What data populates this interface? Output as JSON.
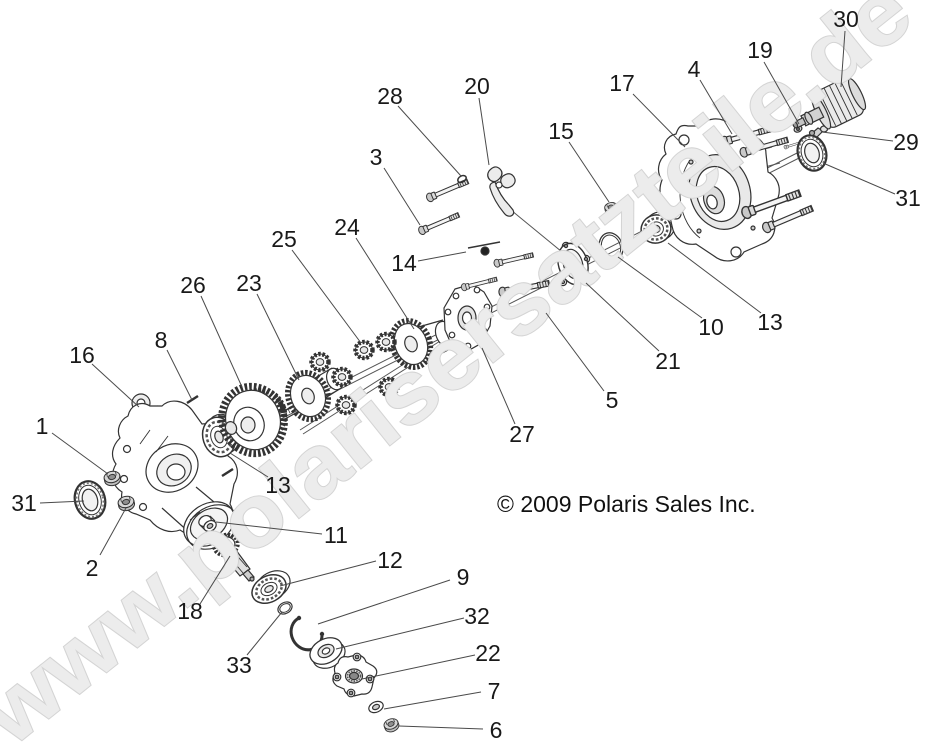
{
  "diagram": {
    "title": "exploded-parts-diagram",
    "copyright": "© 2009 Polaris Sales Inc.",
    "watermark": "www.polarisersatzteile.de"
  },
  "colors": {
    "background": "#ffffff",
    "line_art": "#333333",
    "leader_line": "#4a4a4a",
    "label_text": "#191919",
    "watermark_fill": "#ececec",
    "watermark_outline": "#d4d4d4"
  },
  "labels": [
    {
      "key": "part-label-1",
      "text": "1",
      "x": 42,
      "y": 426,
      "line": [
        52,
        433,
        108,
        474
      ]
    },
    {
      "key": "part-label-2",
      "text": "2",
      "x": 92,
      "y": 568,
      "line": [
        100,
        555,
        126,
        508
      ]
    },
    {
      "key": "part-label-3",
      "text": "3",
      "x": 376,
      "y": 157,
      "line": [
        384,
        168,
        420,
        225
      ]
    },
    {
      "key": "part-label-4",
      "text": "4",
      "x": 694,
      "y": 69,
      "line": [
        700,
        80,
        732,
        134
      ]
    },
    {
      "key": "part-label-5",
      "text": "5",
      "x": 612,
      "y": 400,
      "line": [
        604,
        391,
        546,
        313
      ]
    },
    {
      "key": "part-label-6",
      "text": "6",
      "x": 496,
      "y": 730,
      "line": [
        483,
        729,
        399,
        726
      ]
    },
    {
      "key": "part-label-7",
      "text": "7",
      "x": 494,
      "y": 691,
      "line": [
        481,
        692,
        384,
        709
      ]
    },
    {
      "key": "part-label-8",
      "text": "8",
      "x": 161,
      "y": 340,
      "line": [
        167,
        350,
        192,
        400
      ]
    },
    {
      "key": "part-label-9",
      "text": "9",
      "x": 463,
      "y": 577,
      "line": [
        450,
        580,
        318,
        624
      ]
    },
    {
      "key": "part-label-10",
      "text": "10",
      "x": 711,
      "y": 327,
      "line": [
        702,
        318,
        618,
        257
      ]
    },
    {
      "key": "part-label-11",
      "text": "11",
      "x": 336,
      "y": 535,
      "line": [
        322,
        534,
        216,
        522
      ]
    },
    {
      "key": "part-label-12",
      "text": "12",
      "x": 390,
      "y": 560,
      "line": [
        376,
        561,
        280,
        586
      ]
    },
    {
      "key": "part-label-13-left",
      "text": "13",
      "x": 278,
      "y": 485,
      "line": [
        268,
        477,
        230,
        453
      ]
    },
    {
      "key": "part-label-13-right",
      "text": "13",
      "x": 770,
      "y": 322,
      "line": [
        761,
        313,
        668,
        243
      ]
    },
    {
      "key": "part-label-14",
      "text": "14",
      "x": 404,
      "y": 263,
      "line": [
        418,
        261,
        466,
        252
      ]
    },
    {
      "key": "part-label-15",
      "text": "15",
      "x": 561,
      "y": 131,
      "line": [
        569,
        142,
        609,
        202
      ]
    },
    {
      "key": "part-label-16",
      "text": "16",
      "x": 82,
      "y": 355,
      "line": [
        92,
        364,
        139,
        407
      ]
    },
    {
      "key": "part-label-17",
      "text": "17",
      "x": 622,
      "y": 83,
      "line": [
        633,
        94,
        685,
        147
      ]
    },
    {
      "key": "part-label-18",
      "text": "18",
      "x": 190,
      "y": 611,
      "line": [
        200,
        604,
        230,
        556
      ]
    },
    {
      "key": "part-label-19",
      "text": "19",
      "x": 760,
      "y": 50,
      "line": [
        764,
        62,
        799,
        124
      ]
    },
    {
      "key": "part-label-20",
      "text": "20",
      "x": 477,
      "y": 86,
      "line": [
        479,
        98,
        489,
        165
      ]
    },
    {
      "key": "part-label-21",
      "text": "21",
      "x": 668,
      "y": 361,
      "line": [
        659,
        351,
        586,
        283
      ]
    },
    {
      "key": "part-label-22",
      "text": "22",
      "x": 488,
      "y": 653,
      "line": [
        475,
        655,
        362,
        679
      ]
    },
    {
      "key": "part-label-23",
      "text": "23",
      "x": 249,
      "y": 283,
      "line": [
        257,
        294,
        299,
        380
      ]
    },
    {
      "key": "part-label-24",
      "text": "24",
      "x": 347,
      "y": 227,
      "line": [
        356,
        238,
        414,
        329
      ]
    },
    {
      "key": "part-label-25",
      "text": "25",
      "x": 284,
      "y": 239,
      "line": [
        292,
        250,
        361,
        343
      ]
    },
    {
      "key": "part-label-26",
      "text": "26",
      "x": 193,
      "y": 285,
      "line": [
        201,
        296,
        242,
        387
      ]
    },
    {
      "key": "part-label-27",
      "text": "27",
      "x": 522,
      "y": 434,
      "line": [
        515,
        424,
        482,
        348
      ]
    },
    {
      "key": "part-label-28",
      "text": "28",
      "x": 390,
      "y": 96,
      "line": [
        398,
        106,
        461,
        176
      ]
    },
    {
      "key": "part-label-29",
      "text": "29",
      "x": 906,
      "y": 142,
      "line": [
        893,
        141,
        822,
        132
      ]
    },
    {
      "key": "part-label-30",
      "text": "30",
      "x": 846,
      "y": 19,
      "line": [
        845,
        31,
        841,
        87
      ]
    },
    {
      "key": "part-label-31-left",
      "text": "31",
      "x": 24,
      "y": 503,
      "line": [
        40,
        503,
        84,
        501
      ]
    },
    {
      "key": "part-label-31-top-right",
      "text": "31",
      "x": 908,
      "y": 198,
      "line": [
        895,
        194,
        823,
        163
      ]
    },
    {
      "key": "part-label-32",
      "text": "32",
      "x": 477,
      "y": 616,
      "line": [
        464,
        618,
        336,
        649
      ]
    },
    {
      "key": "part-label-33",
      "text": "33",
      "x": 239,
      "y": 665,
      "line": [
        247,
        655,
        282,
        612
      ]
    }
  ]
}
